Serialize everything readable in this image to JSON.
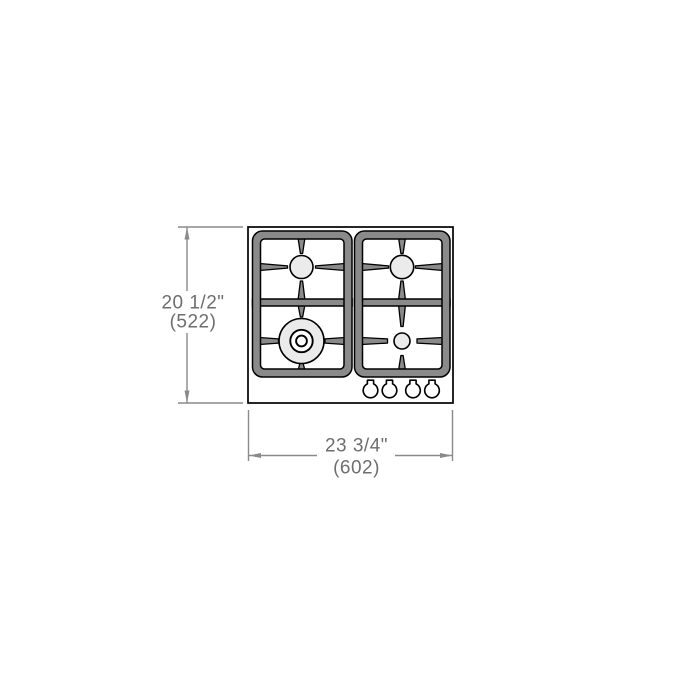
{
  "page": {
    "background_color": "#ffffff",
    "description": "Technical top-view dimension drawing of a 4-burner gas cooktop"
  },
  "drawing": {
    "vertical_dimension": {
      "inches": "20 1/2\"",
      "millimeters": "(522)"
    },
    "horizontal_dimension": {
      "inches": "23 3/4\"",
      "millimeters": "(602)"
    },
    "cooktop": {
      "burner_count": 4,
      "knob_count": 4,
      "burners": [
        {
          "position": "left-rear",
          "size": "medium"
        },
        {
          "position": "right-rear",
          "size": "medium"
        },
        {
          "position": "left-front",
          "size": "large-triple-ring"
        },
        {
          "position": "right-front",
          "size": "small"
        }
      ]
    },
    "colors": {
      "outline": "#000000",
      "grate_fill": "#8a8a8a",
      "burner_fill": "#ebebeb",
      "dimension_line": "#8a8a8a",
      "dimension_text": "#6e6e6e",
      "background": "#ffffff"
    }
  }
}
